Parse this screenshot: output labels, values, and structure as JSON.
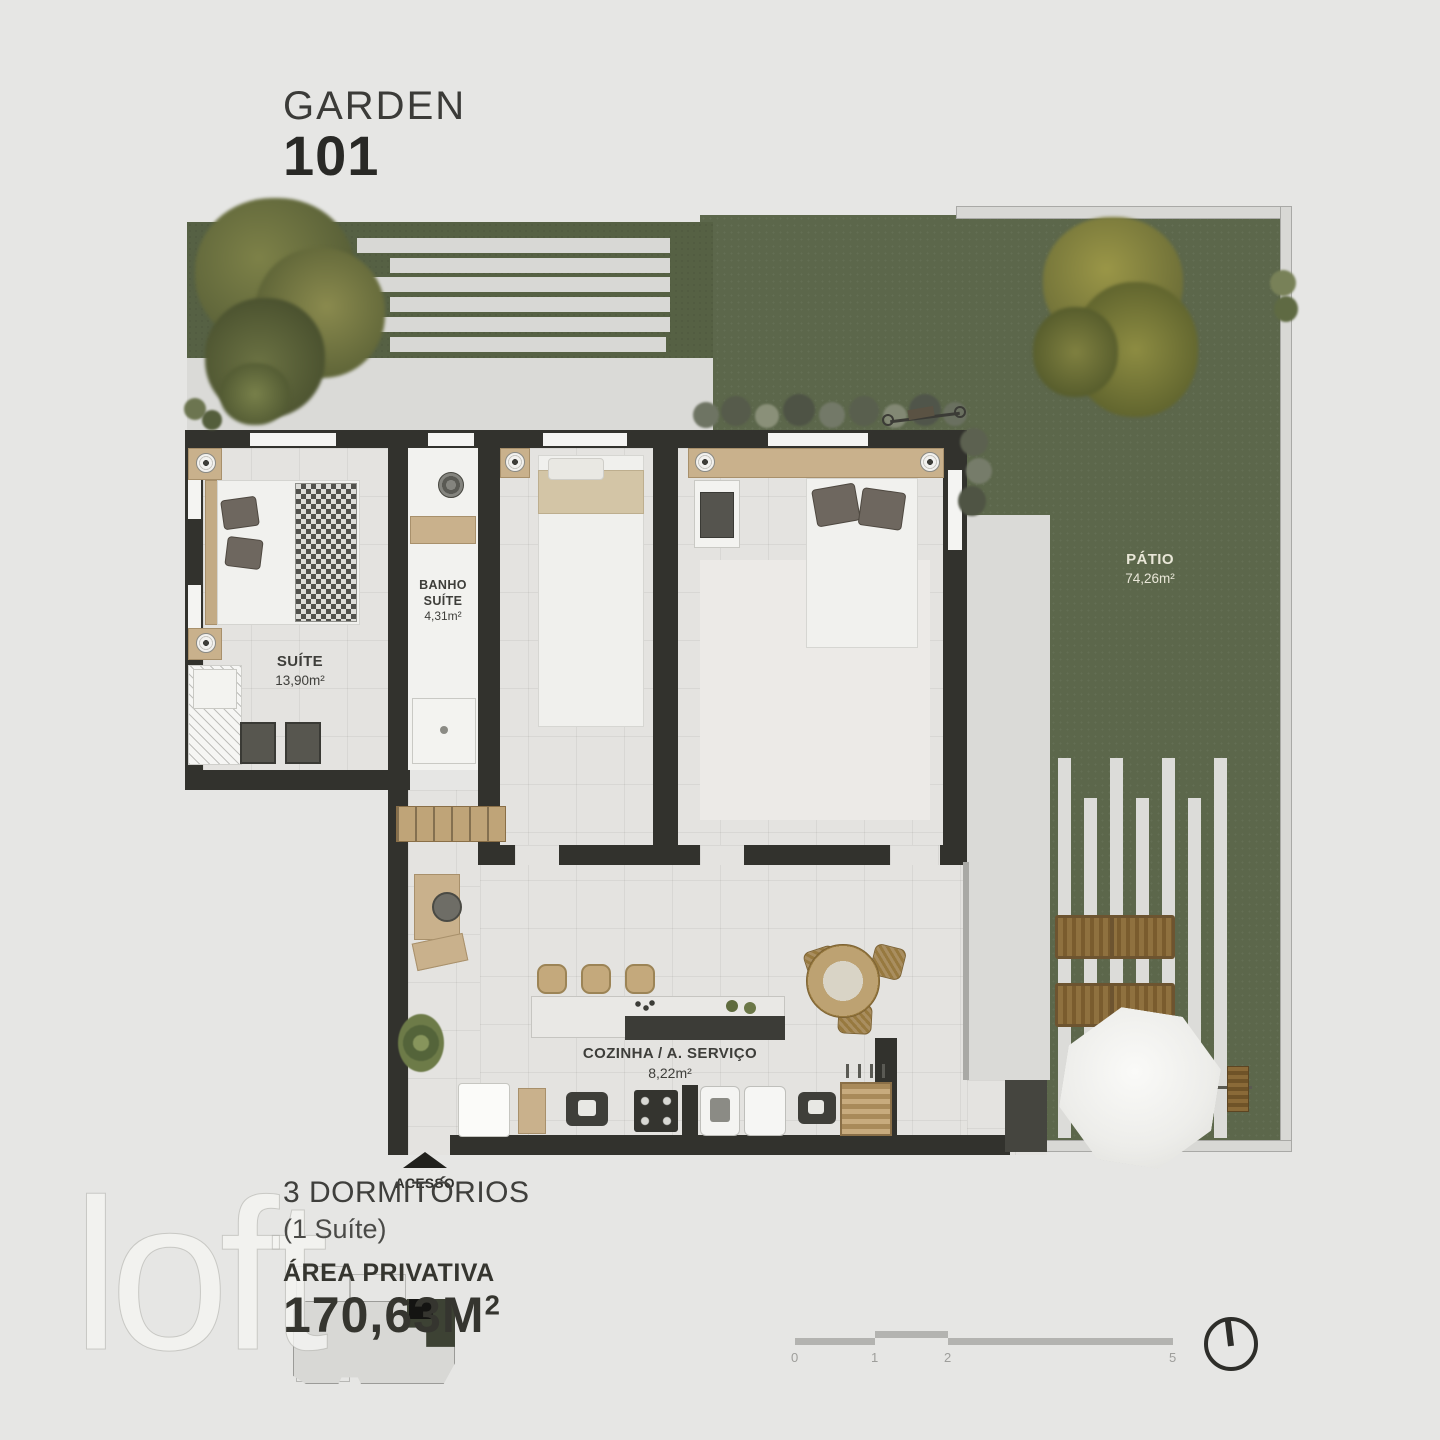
{
  "title": {
    "project": "GARDEN",
    "unit": "101"
  },
  "plan": {
    "rooms": [
      {
        "id": "suite",
        "name": "SUÍTE",
        "area": "13,90m²"
      },
      {
        "id": "banho_suite",
        "name": "BANHO SUÍTE",
        "area": "4,31m²"
      },
      {
        "id": "cozinha_servico",
        "name": "COZINHA / A. SERVIÇO",
        "area": "8,22m²"
      },
      {
        "id": "patio",
        "name": "PÁTIO",
        "area": "74,26m²"
      }
    ],
    "access_label": "ACESSO"
  },
  "summary": {
    "bedrooms": "3 DORMITÓRIOS",
    "suite_note": "(1 Suíte)",
    "private_area_label": "ÁREA PRIVATIVA",
    "private_area_value": "170,63M",
    "private_area_sup": "2"
  },
  "scale_bar": {
    "ticks": [
      "0",
      "1",
      "2",
      "5"
    ]
  },
  "watermark": "loft",
  "icons": {
    "north_indicator": "circle-with-north-needle",
    "access_arrow": "triangle-up"
  },
  "colors": {
    "background": "#e6e6e4",
    "grass": "#5c674b",
    "garden_strip": "#566144",
    "wall": "#32322d",
    "paving": "#d9d9d6",
    "accent_wood": "#c9b18c",
    "text_dark": "#35352f",
    "patio_label_text": "#e9e7d8"
  }
}
